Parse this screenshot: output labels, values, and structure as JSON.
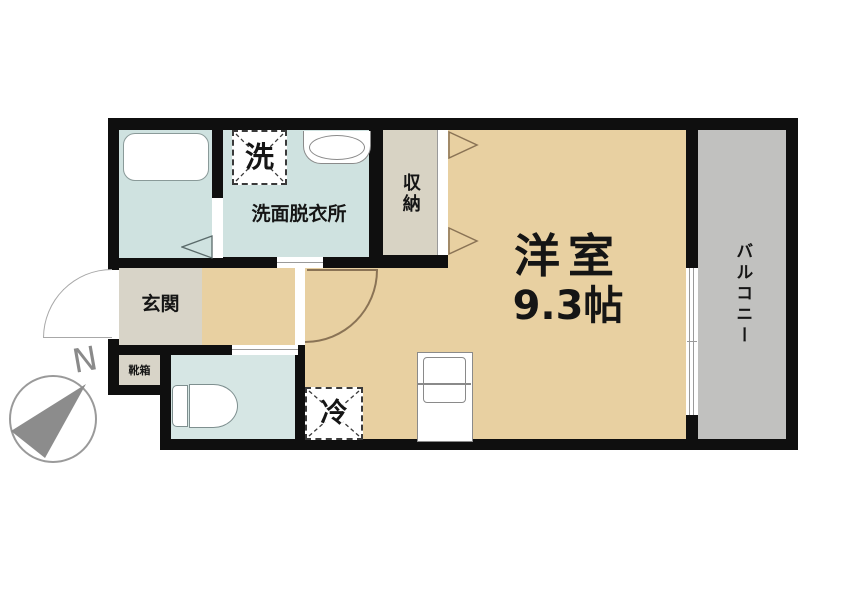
{
  "meta": {
    "type": "apartment-floor-plan"
  },
  "rooms": {
    "main_room": {
      "name": "洋室",
      "size": "9.3帖"
    },
    "washroom": {
      "name": "洗面脱衣所"
    },
    "closet": {
      "name": "収納"
    },
    "balcony": {
      "name": "バルコニー"
    },
    "entrance": {
      "name": "玄関"
    },
    "shoebox": {
      "name": "靴箱"
    }
  },
  "fixtures": {
    "washer_label": "洗",
    "fridge_label": "冷"
  },
  "compass": {
    "north_label": "N"
  },
  "colors": {
    "wall": "#0f0f0f",
    "room_tan": "#e8d0a1",
    "wet_blue": "#cfe2e0",
    "toilet_blue": "#d6e6e4",
    "balcony_gray": "#c1c1bf",
    "entry_gray": "#d8d4c8",
    "closet_gray": "#d8d3c4",
    "fixture_outline": "#8a9a99",
    "door_arc_brown": "#8a7355",
    "compass_gray": "#8c8c8c"
  }
}
